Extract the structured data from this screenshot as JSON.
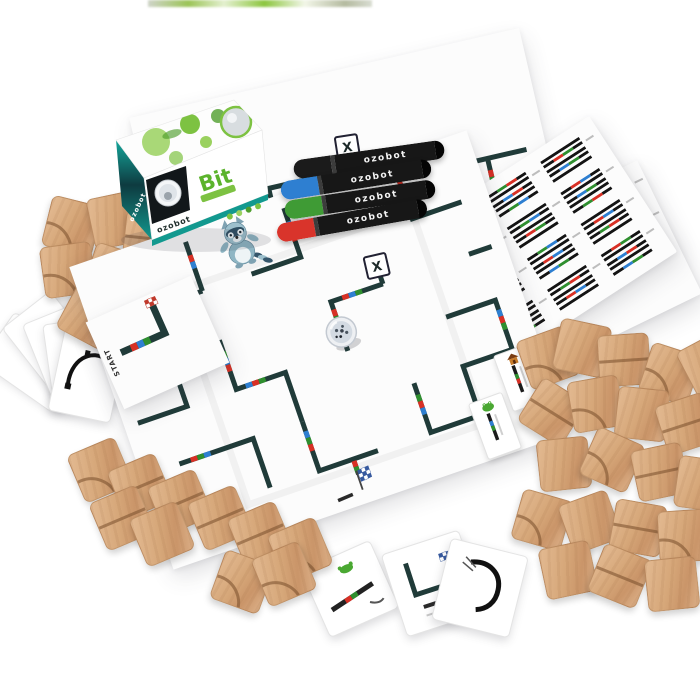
{
  "scene": {
    "background": "#ffffff"
  },
  "brand": {
    "logo": "ozobot"
  },
  "box": {
    "title": "Bit",
    "logo": "ozobot",
    "accent": "#12998f",
    "dark": "#0e2f33",
    "art_green": "#7dc242"
  },
  "markers": {
    "label": "ozobot",
    "body_color": "#171717",
    "cap_colors": [
      "#1b1b1b",
      "#2e7fd1",
      "#3f9b35",
      "#d9342b"
    ]
  },
  "maps": {
    "x_marker": "X",
    "start_label": "START",
    "line_color": "#203b39"
  },
  "code_palette": {
    "K": "#141414",
    "R": "#d83025",
    "G": "#2f8f2f",
    "B": "#2e7fd1"
  },
  "code_sheet": {
    "codes": [
      {
        "bars": [
          "K",
          "KBGK",
          "K",
          "KRBK",
          "K"
        ]
      },
      {
        "bars": [
          "KGRK",
          "K",
          "KBRK",
          "K",
          "KGBK"
        ]
      },
      {
        "bars": [
          "K",
          "KRGK",
          "K",
          "KBGK",
          "K"
        ]
      },
      {
        "bars": [
          "KBRK",
          "K",
          "KGRK",
          "K",
          "KRBK"
        ]
      },
      {
        "bars": [
          "K",
          "KGBK",
          "K",
          "KRGK",
          "K"
        ]
      },
      {
        "bars": [
          "KRBK",
          "K",
          "KBGK",
          "K",
          "KGRK"
        ]
      },
      {
        "bars": [
          "K",
          "KBRK",
          "K",
          "KGBK",
          "K"
        ]
      },
      {
        "bars": [
          "KGBK",
          "K",
          "KRBK",
          "K",
          "KBGK"
        ]
      },
      {
        "bars": [
          "K",
          "KRBK",
          "K",
          "KGRK",
          "K"
        ]
      },
      {
        "bars": [
          "KBGK",
          "K",
          "KGRK",
          "K",
          "KRGK"
        ]
      },
      {
        "bars": [
          "K",
          "KGRK",
          "K",
          "KRBK",
          "K"
        ]
      },
      {
        "bars": [
          "KRGK",
          "K",
          "KBRK",
          "K",
          "KBGK"
        ]
      },
      {
        "bars": [
          "B",
          "K",
          "R"
        ],
        "thick": true
      }
    ]
  },
  "wood": {
    "base": "#ddb28b",
    "mid": "#d09f72",
    "groove": "#8a5f3d"
  }
}
